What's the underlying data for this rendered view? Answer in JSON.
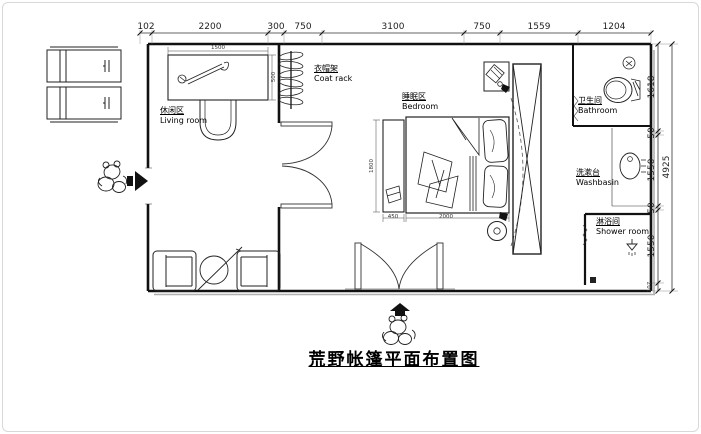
{
  "title": "荒野帐篷平面布置图",
  "dims": {
    "top": [
      "102",
      "2200",
      "300",
      "750",
      "3100",
      "750",
      "1559",
      "1204"
    ],
    "right": [
      "1618",
      "50",
      "1550",
      "50",
      "1550",
      "107"
    ],
    "right_total": "4925",
    "desk_w": "1500",
    "desk_d": "500",
    "bench_w": "450",
    "bed_w": "2000",
    "bed_l": "1800"
  },
  "rooms": {
    "living": {
      "zh": "休闲区",
      "en": "Living room"
    },
    "coatrack": {
      "zh": "衣帽架",
      "en": "Coat rack"
    },
    "bedroom": {
      "zh": "睡眠区",
      "en": "Bedroom"
    },
    "bathroom": {
      "zh": "卫生间",
      "en": "Bathroom"
    },
    "washbasin": {
      "zh": "洗漱台",
      "en": "Washbasin"
    },
    "shower": {
      "zh": "淋浴间",
      "en": "Shower room"
    }
  },
  "colors": {
    "line": "#1a1a1a",
    "shadow": "#b0b0b0",
    "background": "#ffffff"
  }
}
